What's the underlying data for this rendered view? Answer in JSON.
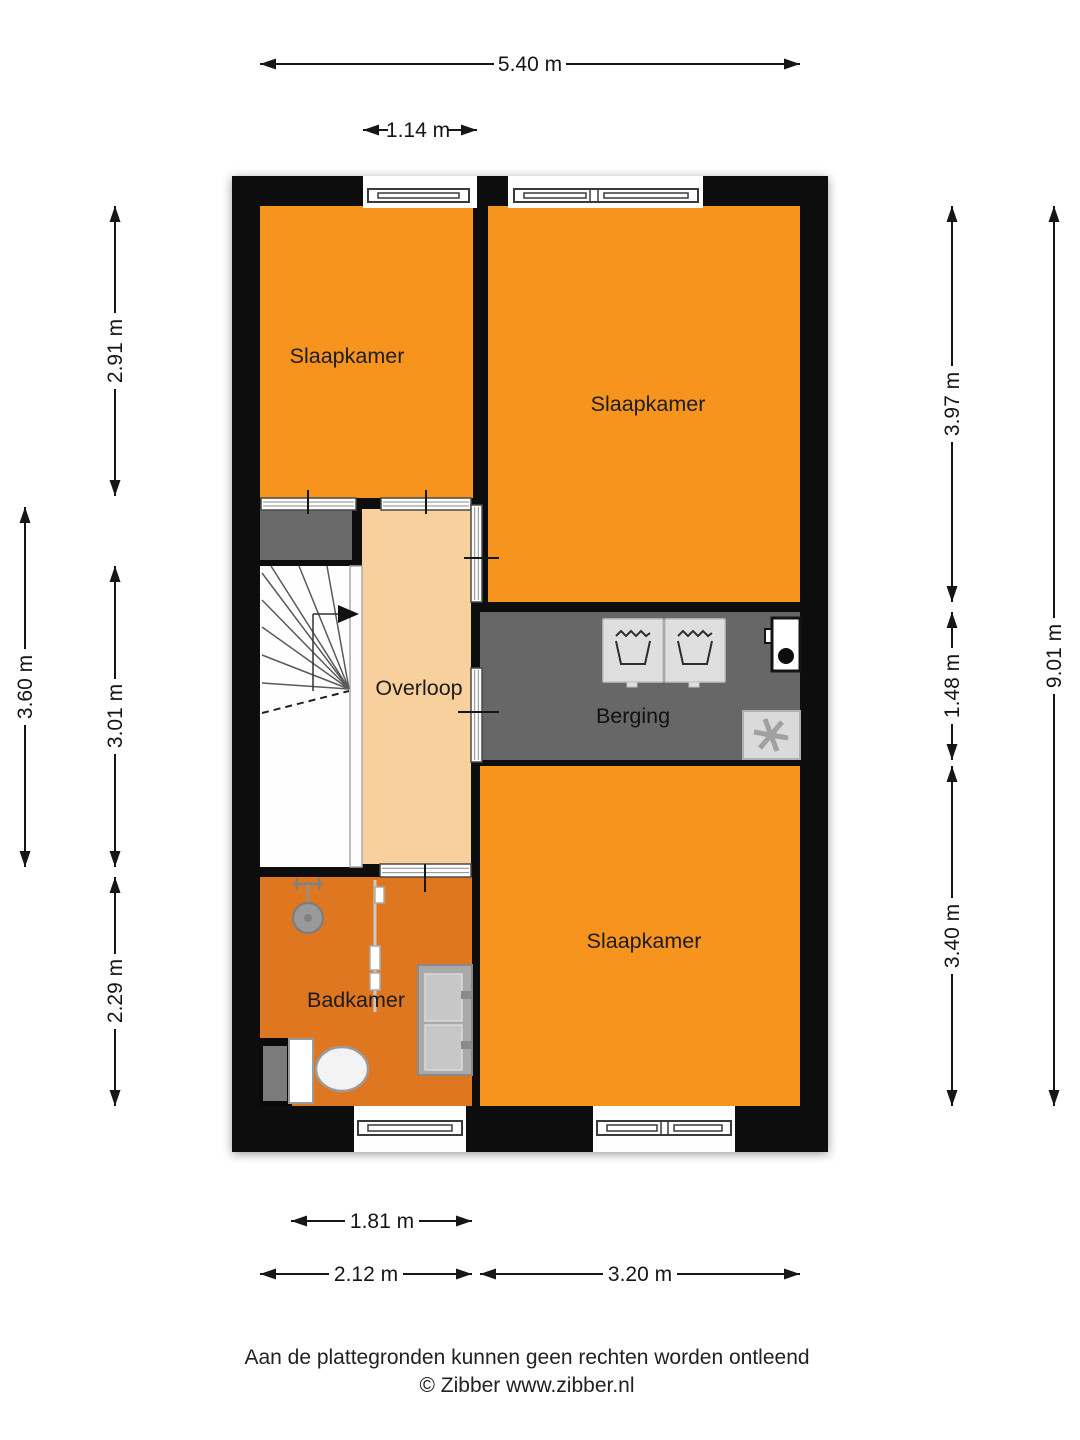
{
  "title": "Floor plan - first floor (verdieping)",
  "rooms": {
    "bedroom_top_left": {
      "label": "Slaapkamer"
    },
    "bedroom_top_right": {
      "label": "Slaapkamer"
    },
    "bedroom_bottom_right": {
      "label": "Slaapkamer"
    },
    "landing": {
      "label": "Overloop"
    },
    "storage": {
      "label": "Berging"
    },
    "bathroom": {
      "label": "Badkamer"
    }
  },
  "dimensions": {
    "top_total": "5.40 m",
    "top_window": "1.14 m",
    "left_top": "2.91 m",
    "left_outer_total": "3.60 m",
    "left_middle": "3.01 m",
    "left_bottom": "2.29 m",
    "right_top": "3.97 m",
    "right_middle": "1.48 m",
    "right_bottom": "3.40 m",
    "right_outer_total": "9.01 m",
    "bottom_inner": "1.81 m",
    "bottom_left": "2.12 m",
    "bottom_right": "3.20 m"
  },
  "footer": {
    "disclaimer": "Aan de plattegronden kunnen geen rechten worden ontleend",
    "copyright": "© Zibber www.zibber.nl"
  },
  "icons": {
    "washing_machine": "wash-tub glyph",
    "mechanical_ventilation": "fan asterisk",
    "utility_unit": "white box with dot",
    "shower": "shower head",
    "toilet": "toilet bowl and cistern",
    "double_sink": "double washbasin",
    "stairs": "winder staircase with direction arrow"
  },
  "colors": {
    "bedroom": "#F7941E",
    "bathroom": "#DF7620",
    "landing": "#F7D09E",
    "storage": "#676767",
    "closet": "#6A6A6A",
    "wall": "#0A0A0A"
  }
}
